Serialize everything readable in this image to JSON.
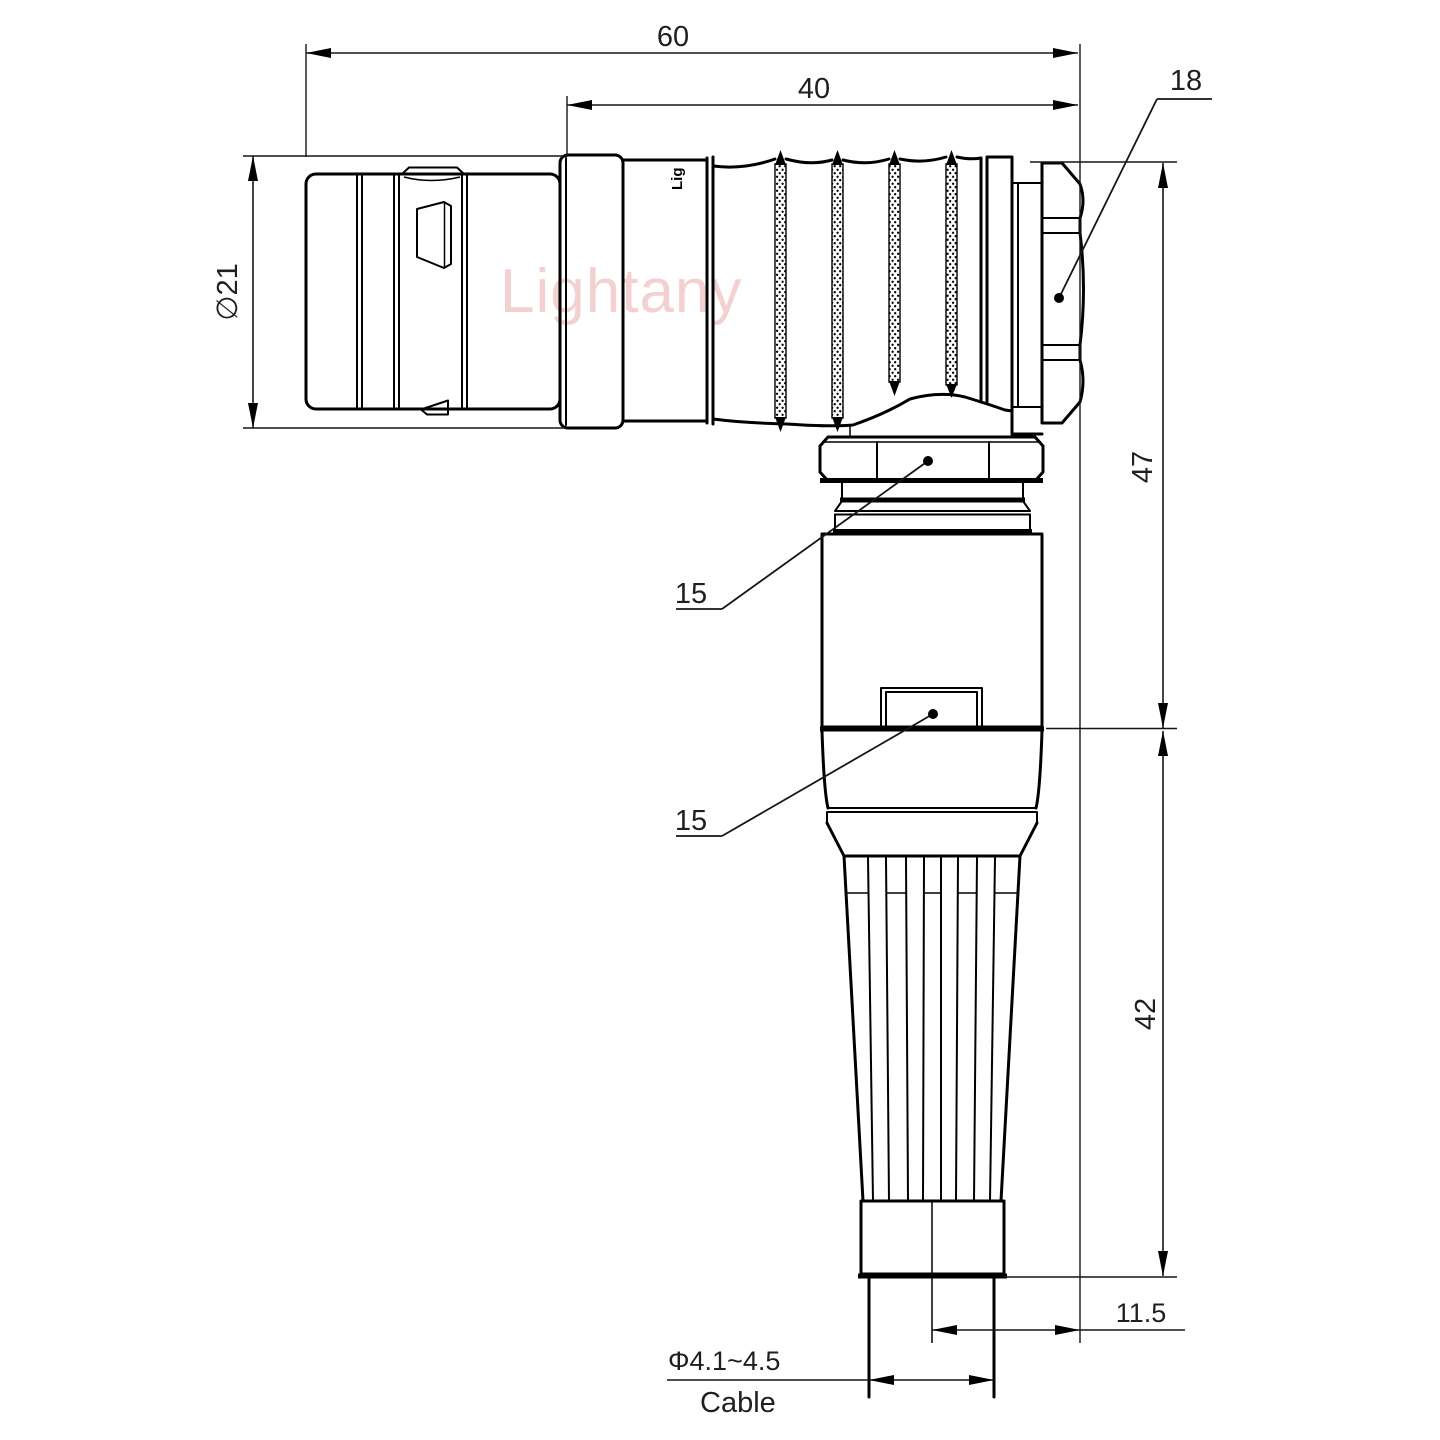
{
  "drawing": {
    "watermark": "Lightany",
    "part_engraving": "Lig",
    "dimensions": {
      "total_length": "60",
      "rear_length": "40",
      "nut_across_flats": "18",
      "shell_diameter": "∅21",
      "elbow_height": "47",
      "boot_height": "42",
      "coupling_nut_size": "15",
      "clip_size": "15",
      "cable_offset": "11.5",
      "cable_diameter": "Φ4.1~4.5",
      "cable_caption": "Cable"
    },
    "colors": {
      "line": "#000000",
      "dimension_text": "#1f1f1f",
      "watermark": "#e79a9a",
      "background": "#ffffff"
    }
  }
}
